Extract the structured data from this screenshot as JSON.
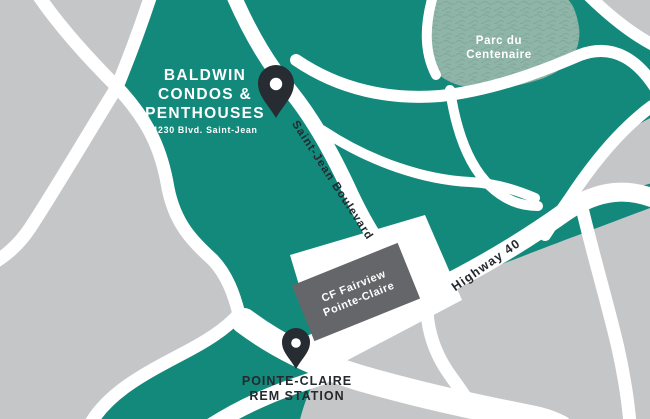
{
  "map": {
    "property": {
      "name_line1": "BALDWIN",
      "name_line2": "CONDOS &",
      "name_line3": "PENTHOUSES",
      "address": "4230 Blvd. Saint-Jean"
    },
    "park": {
      "line1": "Parc du",
      "line2": "Centenaire"
    },
    "roads": {
      "saint_jean": "Saint-Jean Boulevard",
      "highway": "Highway 40"
    },
    "mall": {
      "line1": "CF Fairview",
      "line2": "Pointe-Claire"
    },
    "station": {
      "line1": "POINTE-CLAIRE",
      "line2": "REM STATION"
    },
    "colors": {
      "teal_block": "#12897B",
      "park_green": "#8FB5A8",
      "park_pattern": "#7CA496",
      "background_gray": "#C5C6C8",
      "road_white": "#FFFFFF",
      "mall_box_gray": "#646669",
      "pin_dark": "#262C31",
      "label_dark": "#24292E"
    }
  }
}
